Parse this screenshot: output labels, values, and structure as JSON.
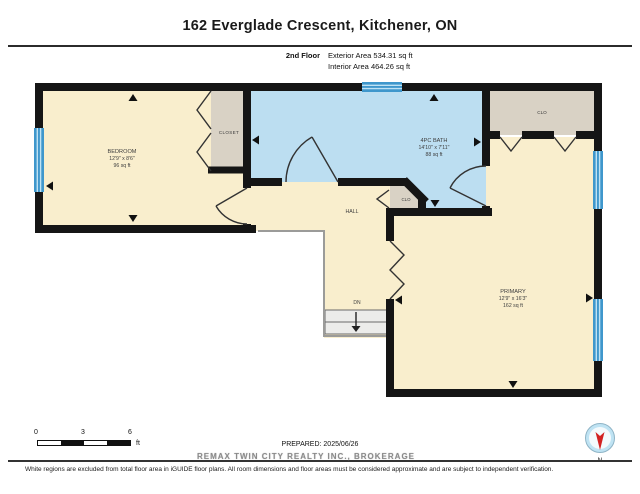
{
  "header": {
    "title": "162 Everglade Crescent, Kitchener, ON",
    "floor_label": "2nd Floor",
    "exterior_area": "Exterior Area 534.31 sq ft",
    "interior_area": "Interior Area 464.26 sq ft"
  },
  "rooms": {
    "bedroom": {
      "name": "BEDROOM",
      "dims": "12'9\" x 8'6\"",
      "area": "96 sq ft"
    },
    "bedroom_closet": {
      "name": "CLOSET"
    },
    "bath": {
      "name": "4PC BATH",
      "dims": "14'10\" x 7'11\"",
      "area": "88 sq ft"
    },
    "hall": {
      "name": "HALL"
    },
    "hall_closet": {
      "name": "CLO"
    },
    "primary": {
      "name": "PRIMARY",
      "dims": "12'9\" x 16'3\"",
      "area": "162 sq ft"
    },
    "primary_closet": {
      "name": "CLO"
    },
    "stairs_label": "DN"
  },
  "scale_bar": {
    "tick0": "0",
    "tick3": "3",
    "tick6": "6",
    "unit": "ft"
  },
  "compass": {
    "north_label": "N"
  },
  "footer": {
    "prepared": "PREPARED: 2025/06/26",
    "watermark": "REMAX TWIN CITY REALTY INC., BROKERAGE",
    "disclaimer": "White regions are excluded from total floor area in iGUIDE floor plans. All room dimensions and floor areas must be considered approximate and are subject to independent verification."
  },
  "colors": {
    "wall": "#151515",
    "room_fill": "#f9eecd",
    "bath_fill": "#bcdef1",
    "closet_fill": "#d9d2c5",
    "window_blue": "#3f97cc",
    "compass_needle": "#d22222"
  }
}
